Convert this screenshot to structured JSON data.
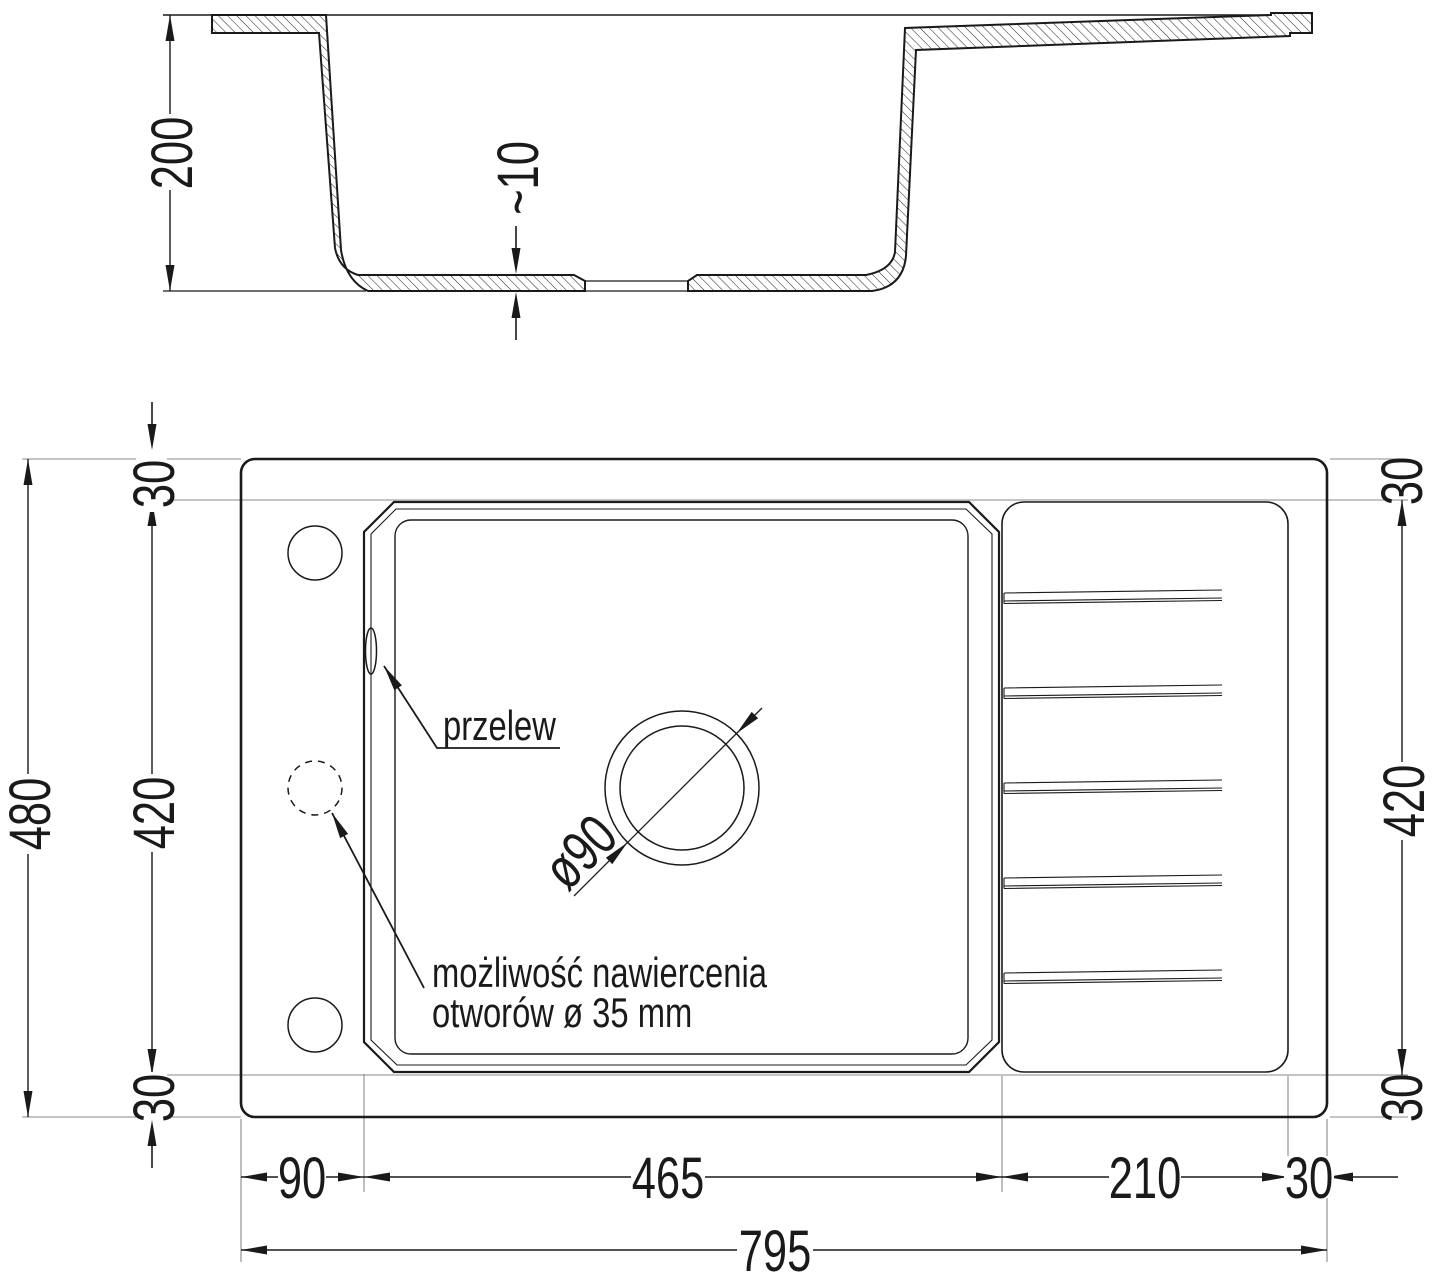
{
  "drawing": {
    "kind": "technical drawing — kitchen sink with drainer, sectional and plan views",
    "colors": {
      "line": "#1a1a1a",
      "extension_line": "#8a8a8a",
      "background": "#ffffff"
    }
  },
  "labels": {
    "h200": "200",
    "t10": "~10",
    "v480": "480",
    "v420_left": "420",
    "v30_top_left": "30",
    "v30_bottom_left": "30",
    "v30_top_right": "30",
    "v420_right": "420",
    "v30_bottom_right": "30",
    "w90": "90",
    "w465": "465",
    "w210": "210",
    "w30_bottom_right": "30",
    "w795": "795",
    "drain_diameter": "ø90",
    "overflow": "przelew",
    "note_line1": "możliwość nawiercenia",
    "note_line2": "otworów ø 35 mm"
  }
}
